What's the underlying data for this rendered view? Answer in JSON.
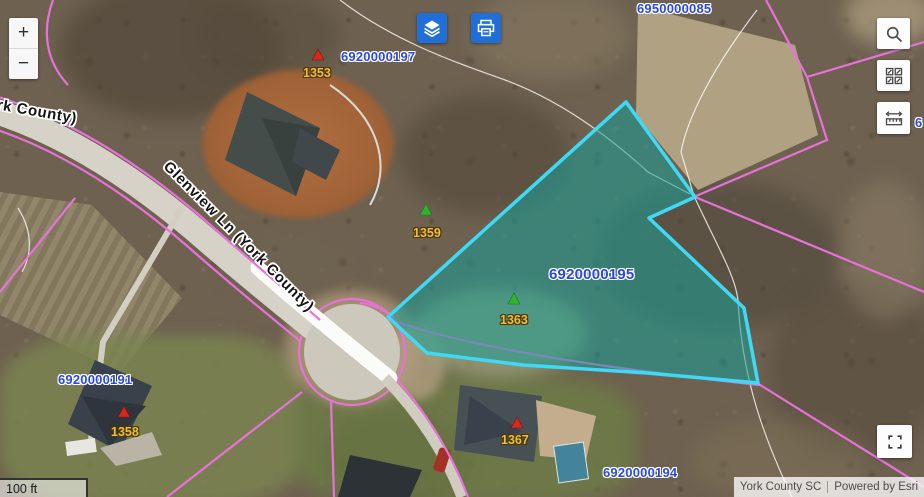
{
  "colors": {
    "accent_blue": "#1f6fd6",
    "parcel_label_blue": "#2b48d6",
    "address_label_gold": "#f0bf41",
    "selected_parcel_outline": "#3fd9f6",
    "selected_parcel_fill": "rgba(23,158,152,0.55)",
    "parcel_line_pink": "#e871da"
  },
  "controls": {
    "zoom_in": "+",
    "zoom_out": "−"
  },
  "map": {
    "selected_parcel": "6920000195",
    "parcel_labels": [
      {
        "text": "6950000085"
      },
      {
        "text": "6920000197"
      },
      {
        "text": "6920000195"
      },
      {
        "text": "6920000191"
      },
      {
        "text": "6920000194"
      },
      {
        "text": "6"
      }
    ],
    "address_labels": [
      {
        "text": "1353",
        "marker": "red"
      },
      {
        "text": "1359",
        "marker": "green"
      },
      {
        "text": "1363",
        "marker": "green"
      },
      {
        "text": "1358",
        "marker": "red"
      },
      {
        "text": "1367",
        "marker": "red"
      }
    ],
    "road_labels": [
      {
        "text": "Glenview Ln (York County)"
      },
      {
        "text": "(York County)"
      }
    ]
  },
  "scalebar": {
    "label": "100 ft"
  },
  "attribution": {
    "source": "York County SC",
    "powered_by": "Powered by Esri"
  }
}
